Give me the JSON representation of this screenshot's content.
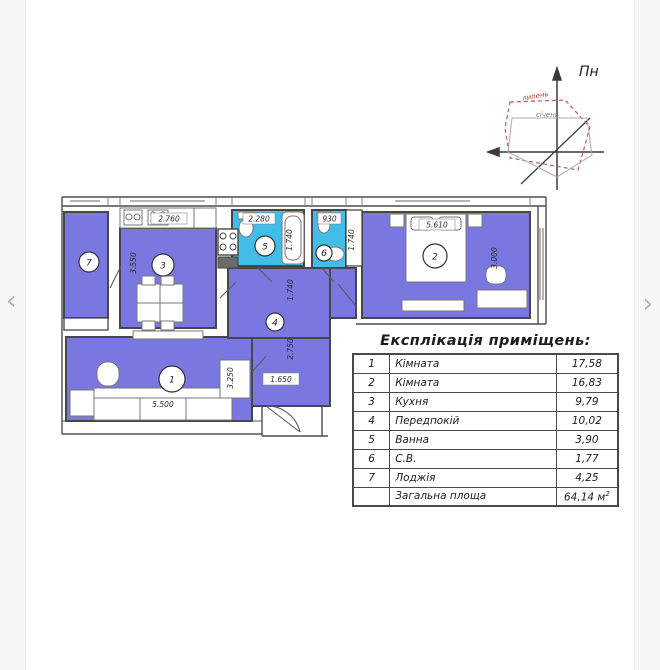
{
  "carousel": {
    "prev": "‹",
    "next": "›"
  },
  "compass": {
    "north_label": "Пн",
    "july_label": "липень",
    "january_label": "січень"
  },
  "plan": {
    "room_numbers": [
      "1",
      "2",
      "3",
      "4",
      "5",
      "6",
      "7"
    ],
    "dims": {
      "kitchen_width": "2.760",
      "kitchen_depth": "3.550",
      "bath_width": "2.280",
      "bath_depth": "1.740",
      "wc_width": "930",
      "shaft_depth": "1.740",
      "hall_top_width": "1.740",
      "hall_depth": "2.750",
      "hall_entry_width": "1.650",
      "room1_width": "5.500",
      "room1_depth": "3.250",
      "room2_width": "5.610",
      "room2_depth": "3.000"
    },
    "colors": {
      "room_fill": "#7b77e0",
      "wet_fill": "#41bde8"
    }
  },
  "table": {
    "title": "Експлікація приміщень:",
    "rows": [
      {
        "num": "1",
        "name": "Кімната",
        "area": "17,58"
      },
      {
        "num": "2",
        "name": "Кімната",
        "area": "16,83"
      },
      {
        "num": "3",
        "name": "Кухня",
        "area": "9,79"
      },
      {
        "num": "4",
        "name": "Передпокій",
        "area": "10,02"
      },
      {
        "num": "5",
        "name": "Ванна",
        "area": "3,90"
      },
      {
        "num": "6",
        "name": "С.В.",
        "area": "1,77"
      },
      {
        "num": "7",
        "name": "Лоджія",
        "area": "4,25"
      }
    ],
    "total": {
      "label": "Загальна площа",
      "value": "64,14 м",
      "sup": "2"
    }
  }
}
